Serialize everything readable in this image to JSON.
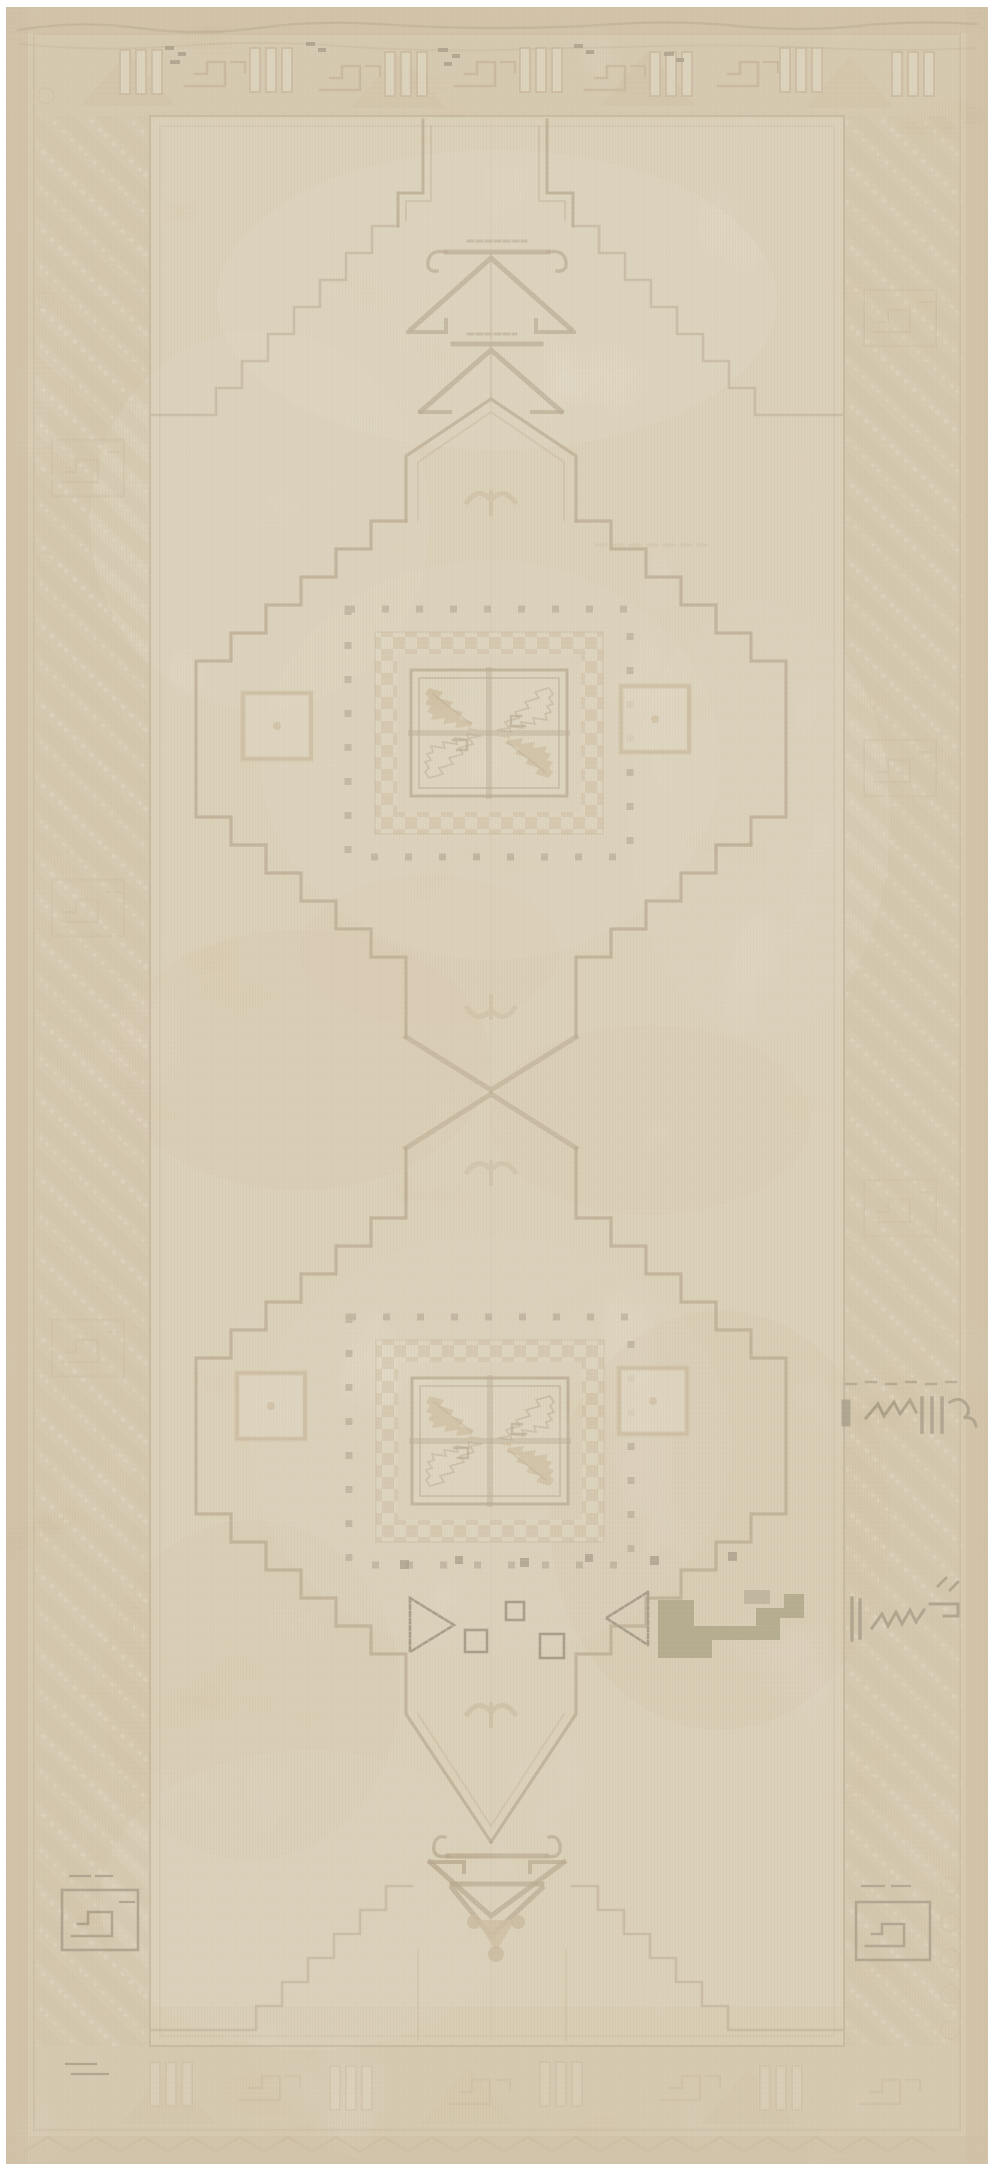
{
  "caption": "Vintage hand-woven beige Anatolian (Oushak style) runner rug, heavily faded, with two stepped diamond medallions, four-quadrant serrated star center boxes, dotted and checkered square rings, stepped gable and chevron-tree finials, diagonal serrated-leaf side borders, and small dark brown and olive-green accent motifs near the lower medallion",
  "image": {
    "subject": "vintage hand-knotted wool rug photographed flat",
    "style": "Anatolian / Oushak geometric runner",
    "condition": "sun-faded, low pile, visible abrash and wear",
    "orientation": "vertical",
    "text_visible": "none"
  },
  "motifs": {
    "top_border": "angular bar groups and hooked meander with dark dash accents",
    "side_borders": "diagonal serrated leaf bands with hooked rectangle cartouches",
    "bottom_edge": "zigzag diamond guard stripe",
    "medallions": [
      {
        "name": "upper stepped diamond medallion",
        "center": "double-outlined square with four serrated leaf-star quadrants",
        "rings": [
          "sparse dark dotted square ring",
          "tan checkered square band"
        ],
        "side_squares": 2
      },
      {
        "name": "lower stepped diamond medallion",
        "center": "double-outlined square with four serrated leaf-star quadrants",
        "rings": [
          "sparse dark dotted square ring",
          "tan checkered square band"
        ],
        "side_squares": 2
      }
    ],
    "top_finial": "stepped gable with double chevron tree and curled hooks",
    "bottom_finial": "hexagon with chevron tree, solid triangle and knobs",
    "connection": "X crossing of serrated diagonals between medallions",
    "accents": [
      "olive-green stepped block",
      "outlined triangles and small squares row",
      "dark brown scribble marks on right border",
      "dark hooked cartouches near bottom corners"
    ]
  },
  "palette": {
    "rug_edge": "#c6ad83",
    "border_bg": "#d7c59f",
    "border_motif": "#b59c72",
    "border_motif_light": "#e9dfc0",
    "field": "#e3d6b4",
    "field_light": "#efe7cc",
    "blush": "#ddbf9d",
    "tan": "#c4ab7c",
    "checker": "#c9b083",
    "line": "#8f7953",
    "line_soft": "#ab9468",
    "dark": "#5f5336",
    "olive": "#767038",
    "knob": "#b79e6f",
    "white": "#ffffff"
  }
}
